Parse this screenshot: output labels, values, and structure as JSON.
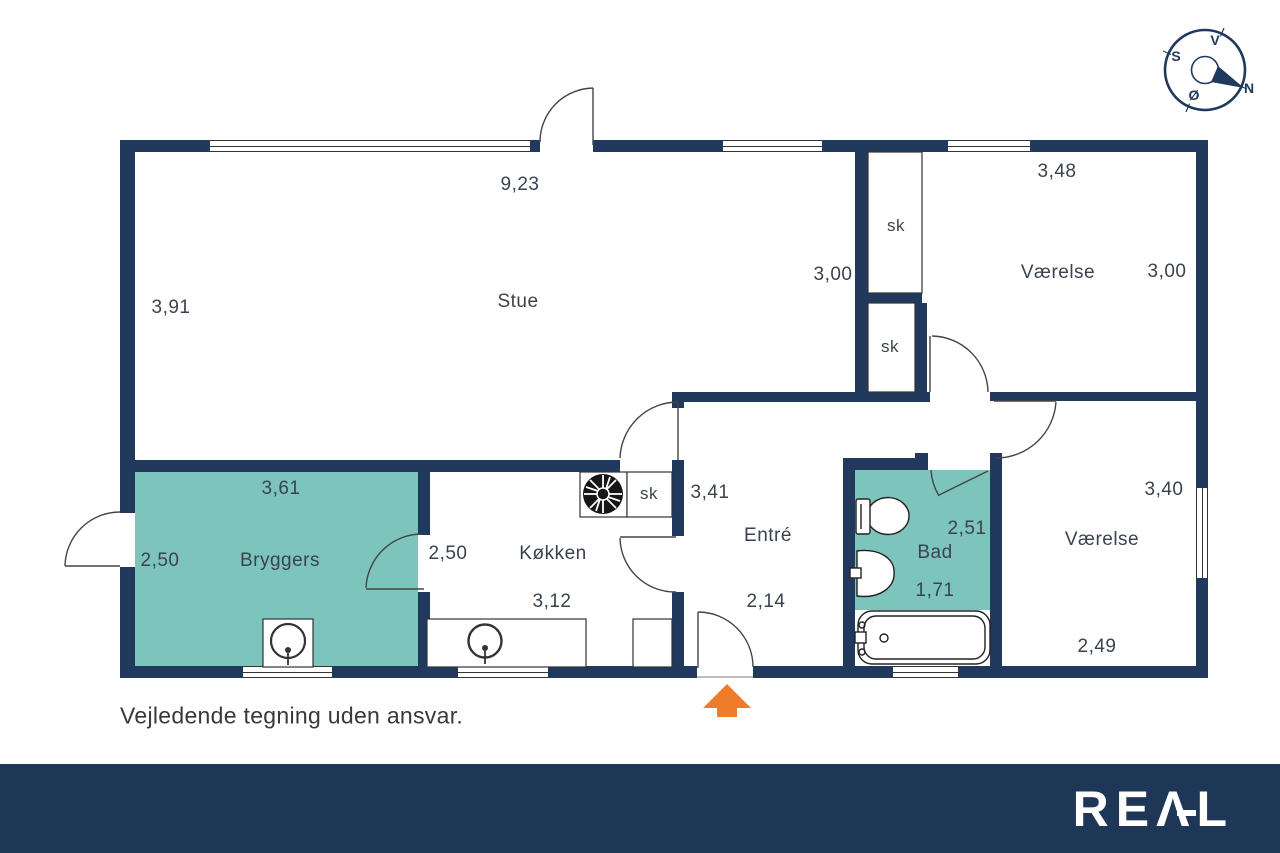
{
  "colors": {
    "wall": "#20395c",
    "footer": "#1f3757",
    "accent_room": "#7dc4bd",
    "arrow": "#ee7c2b",
    "line": "#333333"
  },
  "compass": {
    "north": "N",
    "south": "S",
    "east": "Ø",
    "west": "V"
  },
  "rooms": {
    "stue": {
      "name": "Stue",
      "dim_width": "9,23",
      "dim_left": "3,91",
      "dim_right": "3,00"
    },
    "vaerelse_ne": {
      "name": "Værelse",
      "dim_width": "3,48",
      "dim_height": "3,00"
    },
    "bryggers": {
      "name": "Bryggers",
      "dim_width": "3,61",
      "dim_height": "2,50"
    },
    "koekken": {
      "name": "Køkken",
      "dim_height": "2,50",
      "dim_width": "3,12"
    },
    "entre": {
      "name": "Entré",
      "dim_width": "3,41",
      "dim_bottom": "2,14"
    },
    "bad": {
      "name": "Bad",
      "dim_height": "2,51",
      "dim_width": "1,71"
    },
    "vaerelse_se": {
      "name": "Værelse",
      "dim_height": "3,40",
      "dim_width": "2,49"
    }
  },
  "closets": {
    "c1": "sk",
    "c2": "sk",
    "c3": "sk"
  },
  "title_block": {
    "disclaimer": "Vejledende tegning uden ansvar."
  },
  "footer": {
    "logo": "REAL"
  }
}
